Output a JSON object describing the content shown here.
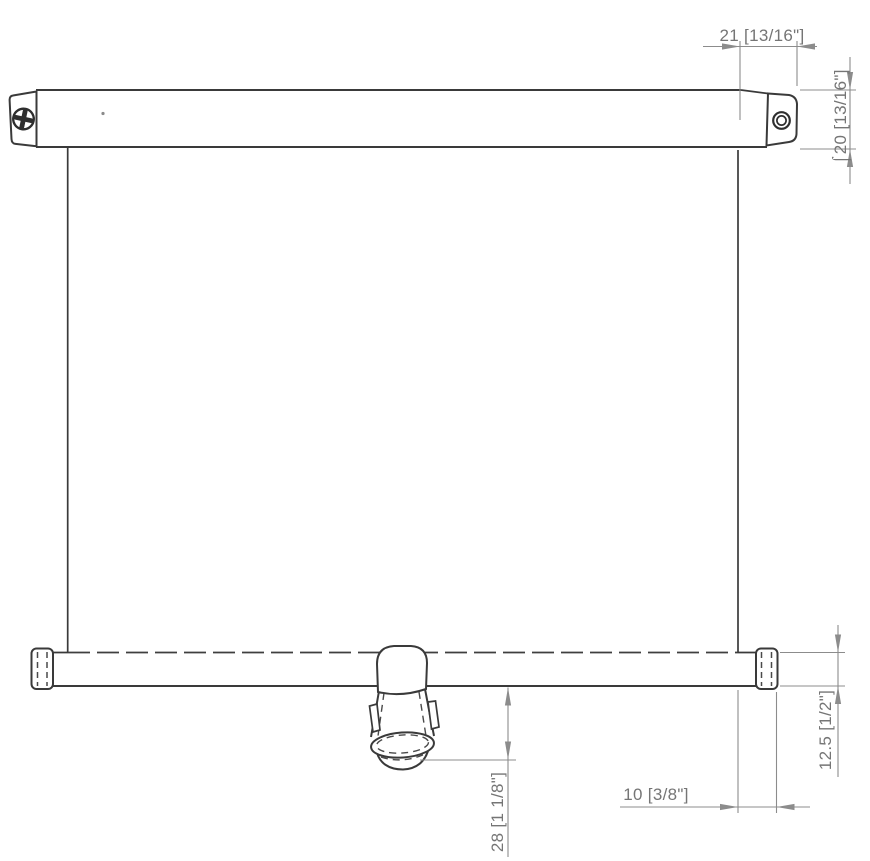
{
  "drawing": {
    "dimensions": {
      "top_cap_width": "21 [13/16\"]",
      "tube_diameter": "⌠20 [13/16\"]",
      "bottom_bar_height": "12.5 [1/2\"]",
      "bottom_cap_overhang": "10 [3/8\"]",
      "knob_drop": "28 [1 1/8\"]"
    },
    "colors": {
      "outline": "#3a3a3a",
      "hidden_line": "#4a4a4a",
      "dimension_line": "#8c8c8c",
      "dimension_text": "#757575",
      "background": "#ffffff"
    }
  }
}
